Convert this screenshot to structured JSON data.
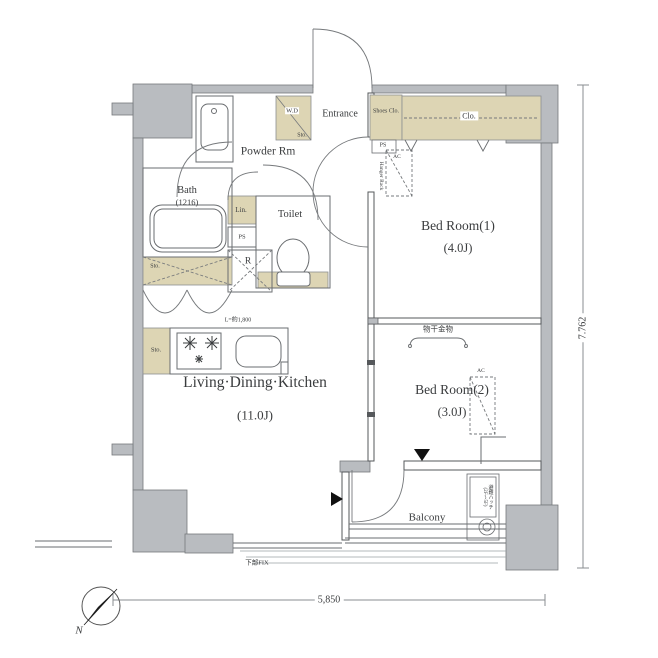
{
  "rooms": {
    "powder": "Powder Rm",
    "bath": "Bath",
    "bath_size": "(1216)",
    "toilet": "Toilet",
    "entrance": "Entrance",
    "bedroom1": "Bed Room(1)",
    "bedroom1_size": "(4.0J)",
    "bedroom2": "Bed Room(2)",
    "bedroom2_size": "(3.0J)",
    "ldk": "Living·Dining·Kitchen",
    "ldk_size": "(11.0J)",
    "balcony": "Balcony"
  },
  "storage": {
    "wd": "W.D",
    "sto_wd": "Sto.",
    "sto_bath": "Sto.",
    "sto_ldk": "Sto.",
    "lin": "Lin.",
    "ps_powder": "PS",
    "ps_entrance": "PS",
    "r": "R",
    "shoes_clo": "Shoes Clo.",
    "clo": "Clo."
  },
  "equipment": {
    "hanger_rack": "Hanger Rack",
    "ac1": "AC",
    "ac2": "AC",
    "monohoshi": "物干金物",
    "kitchen_len": "L=約1,800",
    "fix": "下部FIX",
    "hatch": "避難ハッチ",
    "hatch_sub": "(2F〜5F)"
  },
  "dimensions": {
    "width": "5,850",
    "height": "7.762"
  },
  "compass": {
    "north": "N"
  },
  "colors": {
    "wall": "#b9bcc0",
    "closet": "#ddd5b4",
    "line": "#6a6d70"
  }
}
